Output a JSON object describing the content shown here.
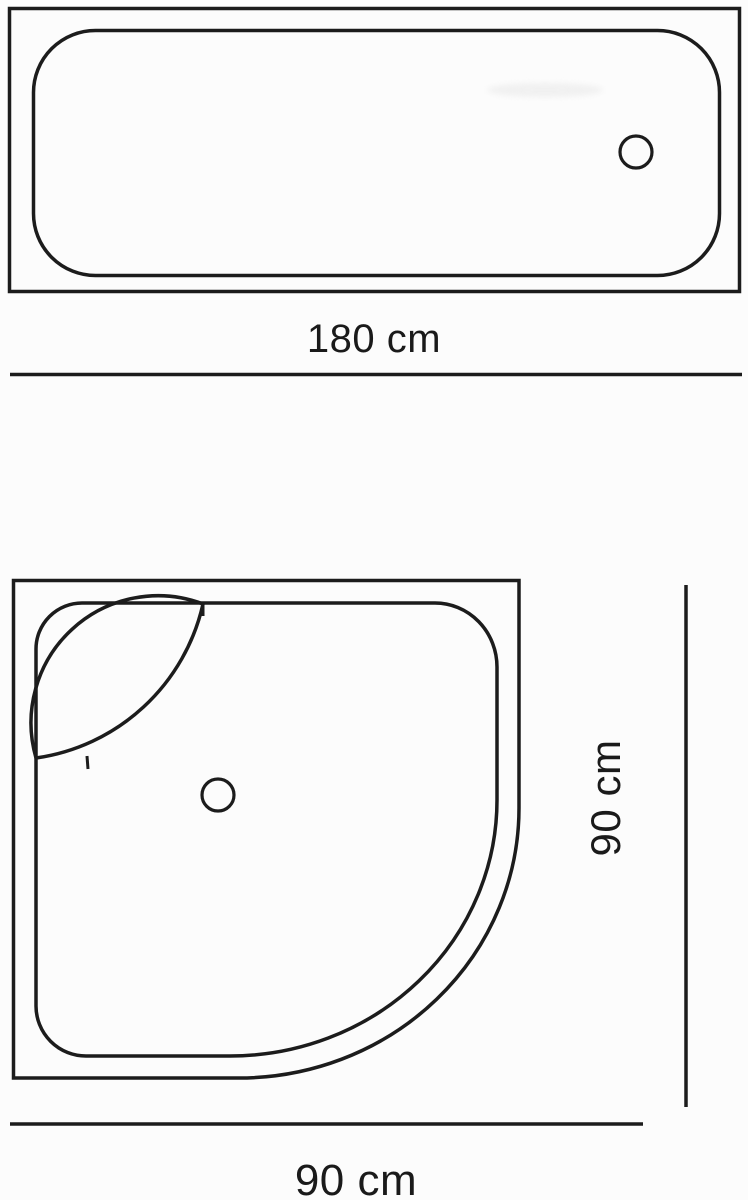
{
  "colors": {
    "ink": "#1c1c1c",
    "background": "#fcfcfc"
  },
  "bathtub": {
    "length_label": "180 cm"
  },
  "shower_tray": {
    "height_label": "90 cm",
    "width_label": "90 cm"
  }
}
